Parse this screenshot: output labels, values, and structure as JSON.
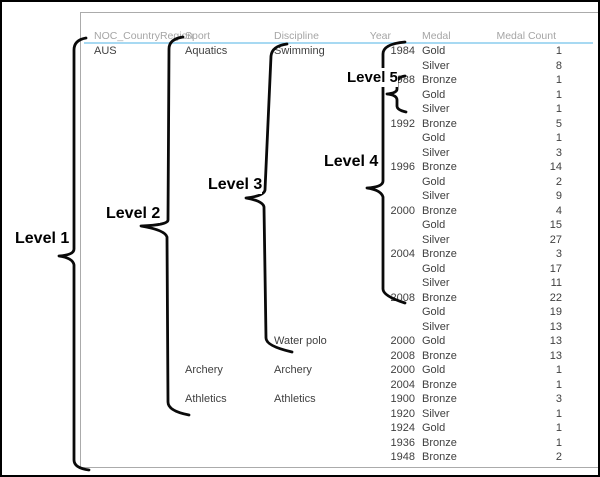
{
  "header": {
    "columns": [
      "NOC_CountryRegion",
      "Sport",
      "Discipline",
      "Year",
      "Medal",
      "Medal Count"
    ]
  },
  "table": {
    "rows": [
      {
        "noc": "AUS",
        "sport": "Aquatics",
        "discipline": "Swimming",
        "year": "1984",
        "medal": "Gold",
        "count": "1"
      },
      {
        "noc": "",
        "sport": "",
        "discipline": "",
        "year": "",
        "medal": "Silver",
        "count": "8"
      },
      {
        "noc": "",
        "sport": "",
        "discipline": "",
        "year": "1988",
        "medal": "Bronze",
        "count": "1"
      },
      {
        "noc": "",
        "sport": "",
        "discipline": "",
        "year": "",
        "medal": "Gold",
        "count": "1"
      },
      {
        "noc": "",
        "sport": "",
        "discipline": "",
        "year": "",
        "medal": "Silver",
        "count": "1"
      },
      {
        "noc": "",
        "sport": "",
        "discipline": "",
        "year": "1992",
        "medal": "Bronze",
        "count": "5"
      },
      {
        "noc": "",
        "sport": "",
        "discipline": "",
        "year": "",
        "medal": "Gold",
        "count": "1"
      },
      {
        "noc": "",
        "sport": "",
        "discipline": "",
        "year": "",
        "medal": "Silver",
        "count": "3"
      },
      {
        "noc": "",
        "sport": "",
        "discipline": "",
        "year": "1996",
        "medal": "Bronze",
        "count": "14"
      },
      {
        "noc": "",
        "sport": "",
        "discipline": "",
        "year": "",
        "medal": "Gold",
        "count": "2"
      },
      {
        "noc": "",
        "sport": "",
        "discipline": "",
        "year": "",
        "medal": "Silver",
        "count": "9"
      },
      {
        "noc": "",
        "sport": "",
        "discipline": "",
        "year": "2000",
        "medal": "Bronze",
        "count": "4"
      },
      {
        "noc": "",
        "sport": "",
        "discipline": "",
        "year": "",
        "medal": "Gold",
        "count": "15"
      },
      {
        "noc": "",
        "sport": "",
        "discipline": "",
        "year": "",
        "medal": "Silver",
        "count": "27"
      },
      {
        "noc": "",
        "sport": "",
        "discipline": "",
        "year": "2004",
        "medal": "Bronze",
        "count": "3"
      },
      {
        "noc": "",
        "sport": "",
        "discipline": "",
        "year": "",
        "medal": "Gold",
        "count": "17"
      },
      {
        "noc": "",
        "sport": "",
        "discipline": "",
        "year": "",
        "medal": "Silver",
        "count": "11"
      },
      {
        "noc": "",
        "sport": "",
        "discipline": "",
        "year": "2008",
        "medal": "Bronze",
        "count": "22"
      },
      {
        "noc": "",
        "sport": "",
        "discipline": "",
        "year": "",
        "medal": "Gold",
        "count": "19"
      },
      {
        "noc": "",
        "sport": "",
        "discipline": "",
        "year": "",
        "medal": "Silver",
        "count": "13"
      },
      {
        "noc": "",
        "sport": "",
        "discipline": "Water polo",
        "year": "2000",
        "medal": "Gold",
        "count": "13"
      },
      {
        "noc": "",
        "sport": "",
        "discipline": "",
        "year": "2008",
        "medal": "Bronze",
        "count": "13"
      },
      {
        "noc": "",
        "sport": "Archery",
        "discipline": "Archery",
        "year": "2000",
        "medal": "Gold",
        "count": "1"
      },
      {
        "noc": "",
        "sport": "",
        "discipline": "",
        "year": "2004",
        "medal": "Bronze",
        "count": "1"
      },
      {
        "noc": "",
        "sport": "Athletics",
        "discipline": "Athletics",
        "year": "1900",
        "medal": "Bronze",
        "count": "3"
      },
      {
        "noc": "",
        "sport": "",
        "discipline": "",
        "year": "1920",
        "medal": "Silver",
        "count": "1"
      },
      {
        "noc": "",
        "sport": "",
        "discipline": "",
        "year": "1924",
        "medal": "Gold",
        "count": "1"
      },
      {
        "noc": "",
        "sport": "",
        "discipline": "",
        "year": "1936",
        "medal": "Bronze",
        "count": "1"
      },
      {
        "noc": "",
        "sport": "",
        "discipline": "",
        "year": "1948",
        "medal": "Bronze",
        "count": "2"
      }
    ]
  },
  "annotations": {
    "labels": [
      "Level 1",
      "Level 2",
      "Level 3",
      "Level 4",
      "Level 5"
    ]
  },
  "colors": {
    "header_underline": "#a7d9f2",
    "header_text": "#a5a5a5",
    "cell_text": "#3f3f3f",
    "brace": "#0a0a0a",
    "panel_border": "#ababab",
    "outer_border": "#000000"
  }
}
